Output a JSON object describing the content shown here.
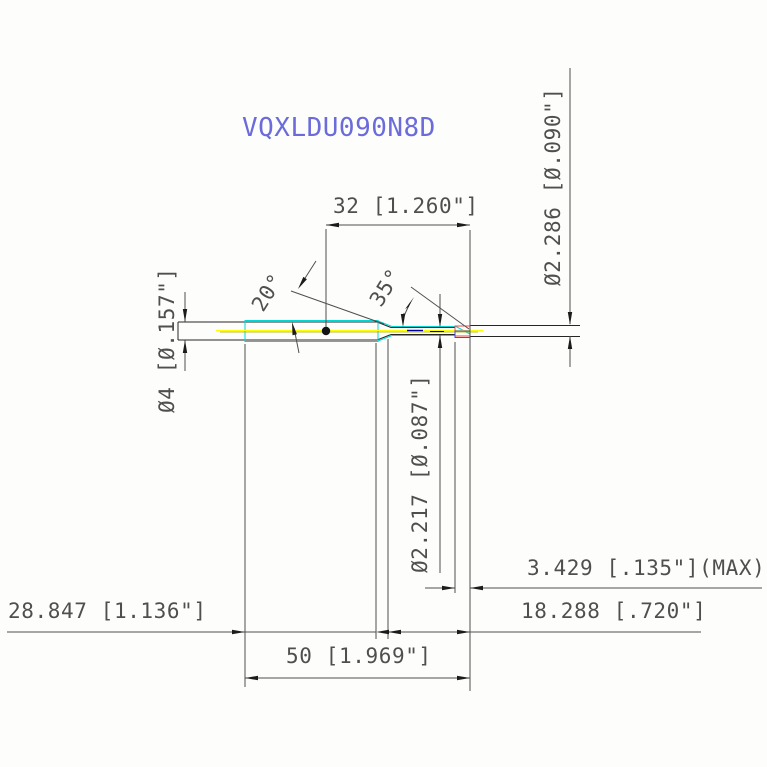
{
  "title": {
    "part_number": "VQXLDU090N8D"
  },
  "dimensions": {
    "length_32": "32 [1.260\"]",
    "dia_2286": "Ø2.286 [Ø.090\"]",
    "dia_4": "Ø4 [Ø.157\"]",
    "dia_2217": "Ø2.217 [Ø.087\"]",
    "tip_3429": "3.429 [.135\"](MAX)",
    "length_18288": "18.288 [.720\"]",
    "length_28847": "28.847 [1.136\"]",
    "length_50": "50 [1.969\"]",
    "angle_20": "20°",
    "angle_35": "35°"
  },
  "colors": {
    "accent_title": "#6b6bdb",
    "outline": "#262626",
    "dimension": "#4f4f4f",
    "highlight_cyan": "#00d8d8",
    "centerline_yellow": "#ffff00",
    "centerline_olive": "#a3a300",
    "tip_red": "#ff4747",
    "tip_blue": "#4646ff",
    "inner_navy": "#000099"
  }
}
